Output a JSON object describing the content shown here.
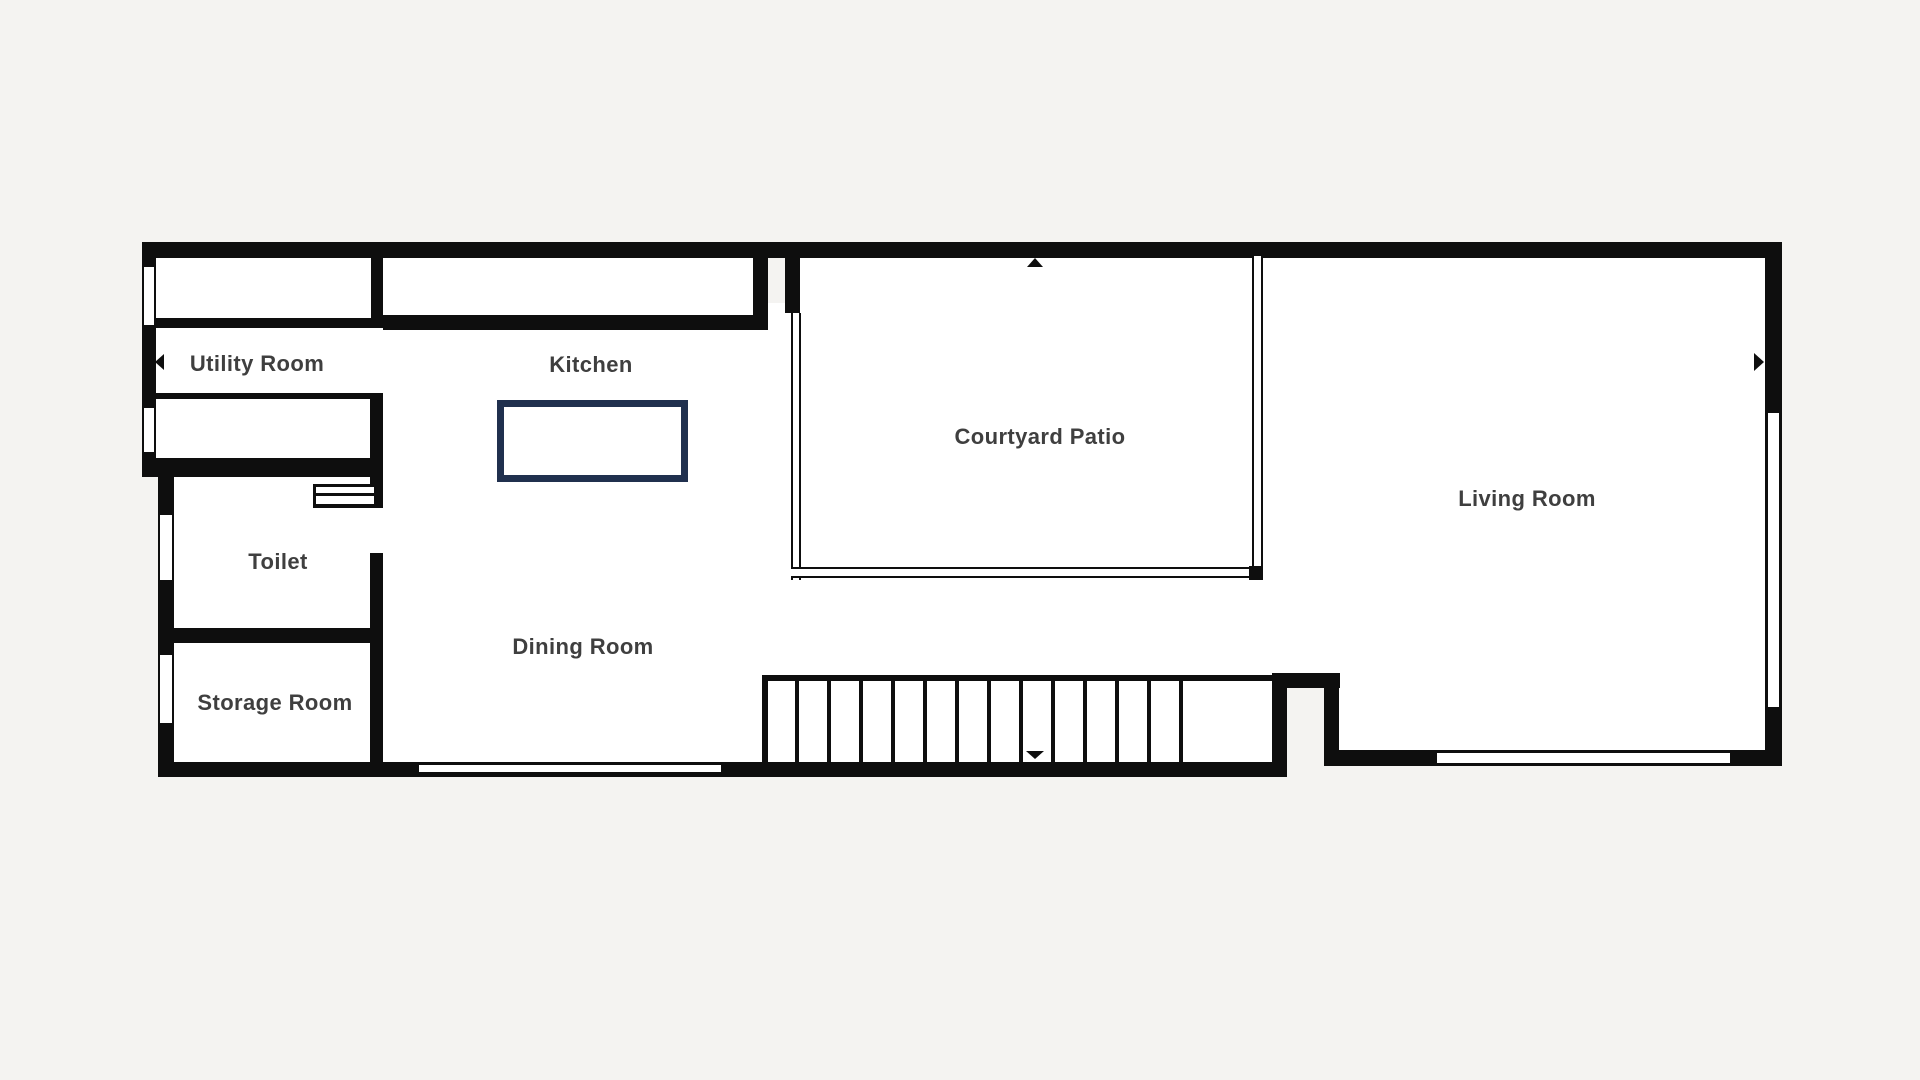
{
  "title": "Ground floor plan",
  "colors": {
    "background": "#f4f3f1",
    "floor": "#ffffff",
    "wall": "#0e0e0e",
    "island": "#20304e",
    "label": "#3f3f3f"
  },
  "rooms": {
    "utility": {
      "label": "Utility Room"
    },
    "kitchen": {
      "label": "Kitchen"
    },
    "courtyard": {
      "label": "Courtyard Patio"
    },
    "living": {
      "label": "Living Room"
    },
    "toilet": {
      "label": "Toilet"
    },
    "dining": {
      "label": "Dining Room"
    },
    "storage": {
      "label": "Storage Room"
    }
  },
  "stairs": {
    "tread_count": 13,
    "direction_marker": "down-triangle"
  },
  "markers": {
    "utility_entry": "left-triangle",
    "living_entry": "right-triangle",
    "courtyard_entry": "up-triangle"
  }
}
